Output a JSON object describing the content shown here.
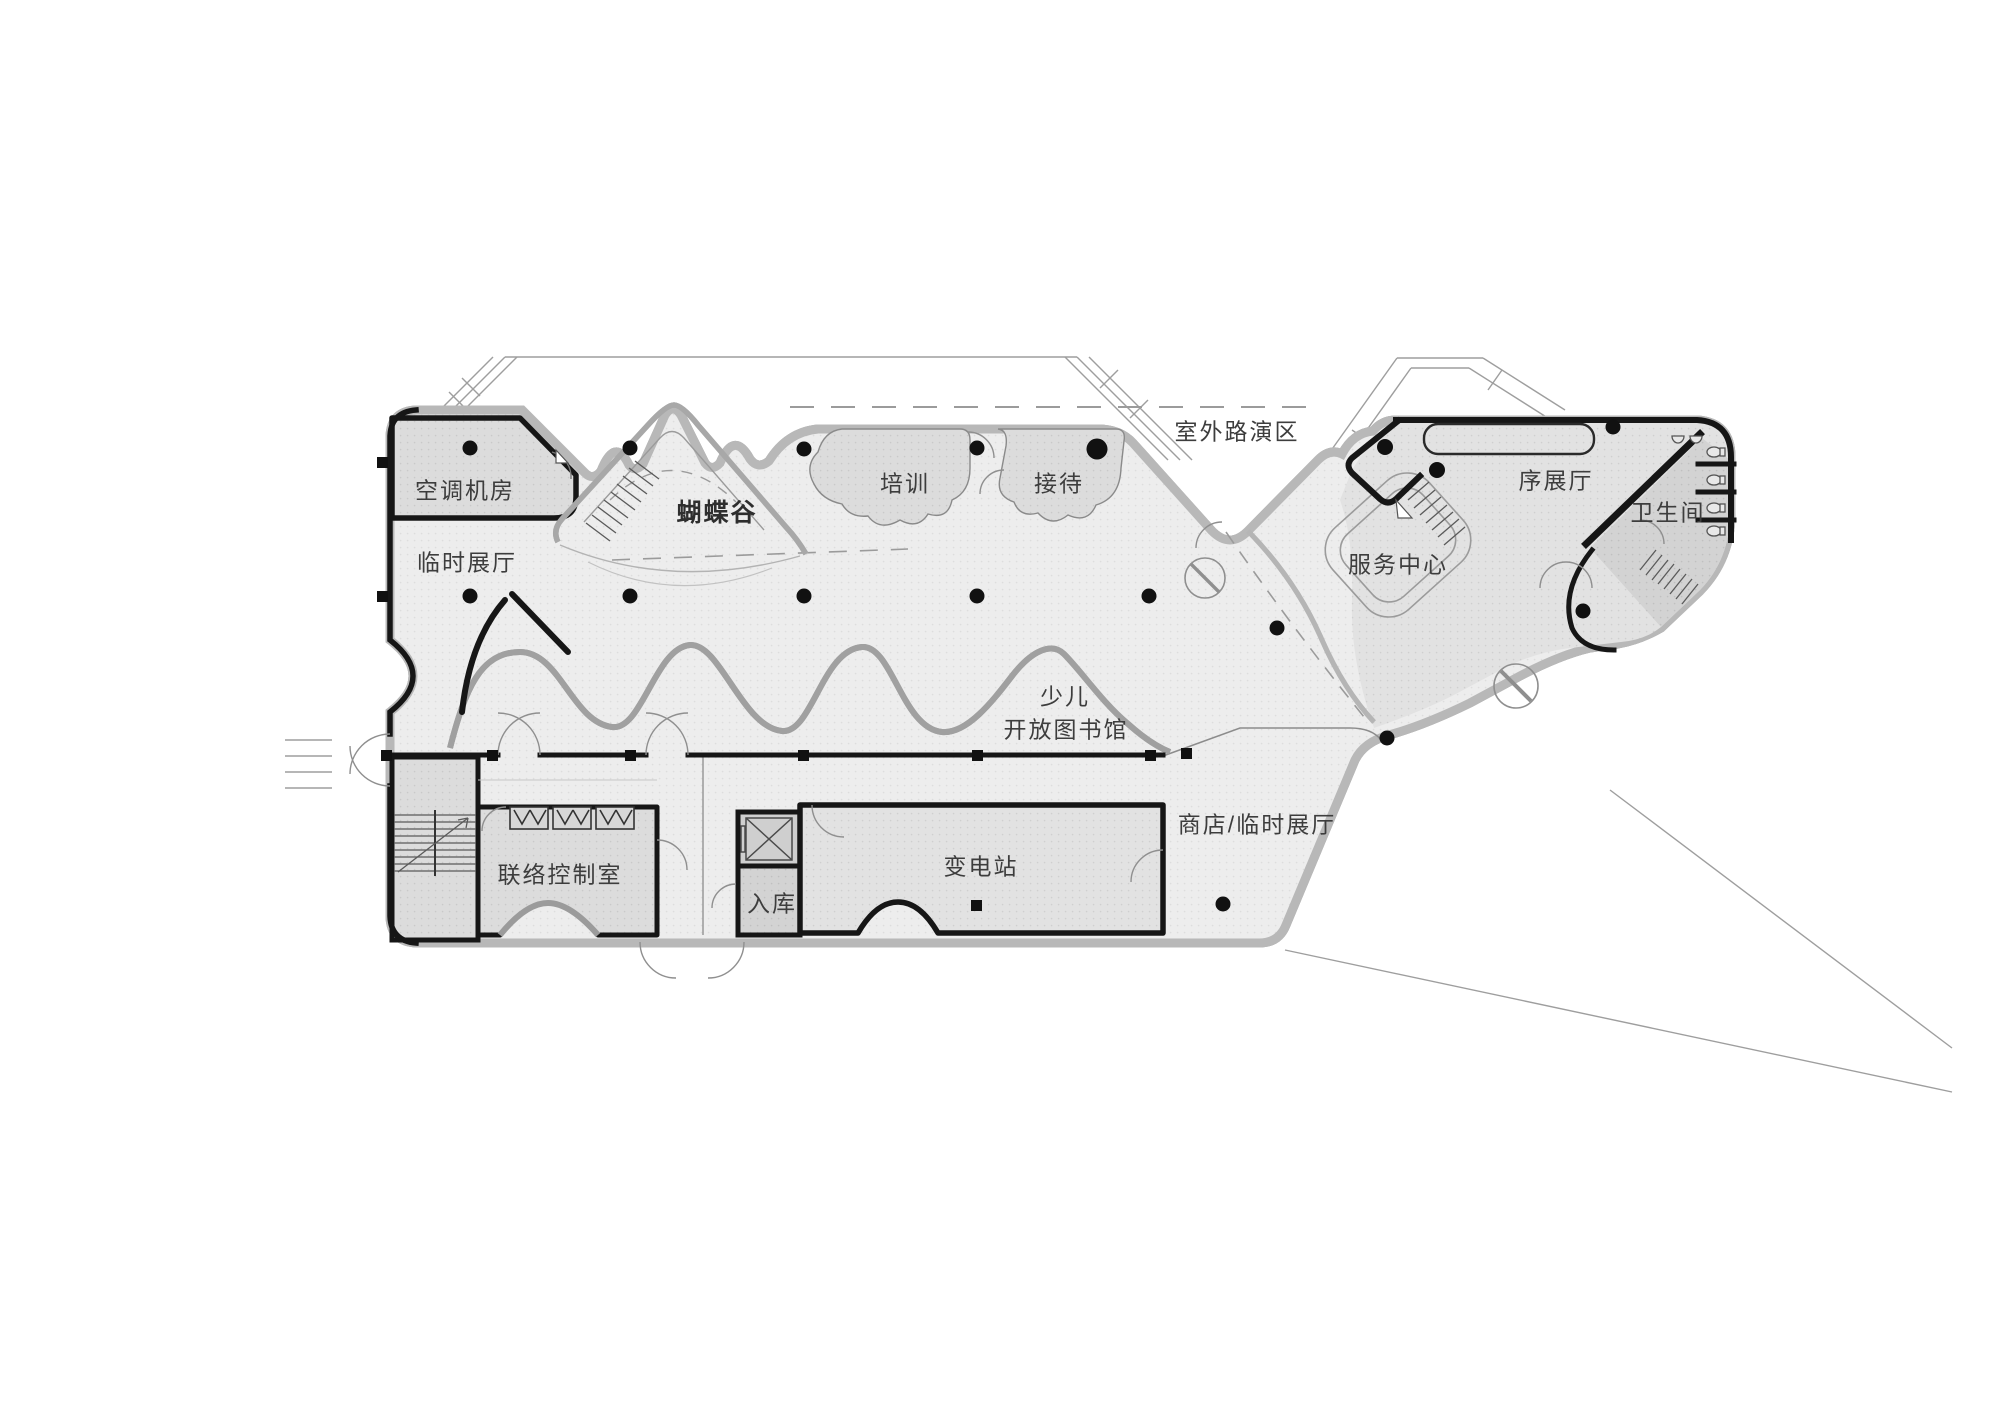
{
  "drawing": {
    "type": "architectural-floor-plan",
    "colors": {
      "background": "#ffffff",
      "floor": "#ededed",
      "room": "#dcdcdc",
      "dark_room": "#d3d3d3",
      "wall": "#161616",
      "thin_line": "#9b9b9b",
      "text": "#3d3d3d"
    }
  },
  "labels": [
    {
      "id": "ac-machine-room",
      "text": "空调机房"
    },
    {
      "id": "temporary-exhibition",
      "text": "临时展厅"
    },
    {
      "id": "butterfly-valley",
      "text": "蝴蝶谷"
    },
    {
      "id": "training",
      "text": "培训"
    },
    {
      "id": "reception",
      "text": "接待"
    },
    {
      "id": "outdoor-roadshow",
      "text": "室外路演区"
    },
    {
      "id": "preface-hall",
      "text": "序展厅"
    },
    {
      "id": "restroom",
      "text": "卫生间"
    },
    {
      "id": "service-center",
      "text": "服务中心"
    },
    {
      "id": "children-line1",
      "text": "少儿"
    },
    {
      "id": "children-line2",
      "text": "开放图书馆"
    },
    {
      "id": "shop-temp-exhibition",
      "text": "商店/临时展厅"
    },
    {
      "id": "liaison-control-room",
      "text": "联络控制室"
    },
    {
      "id": "storage-entry",
      "text": "入库"
    },
    {
      "id": "substation",
      "text": "变电站"
    }
  ]
}
